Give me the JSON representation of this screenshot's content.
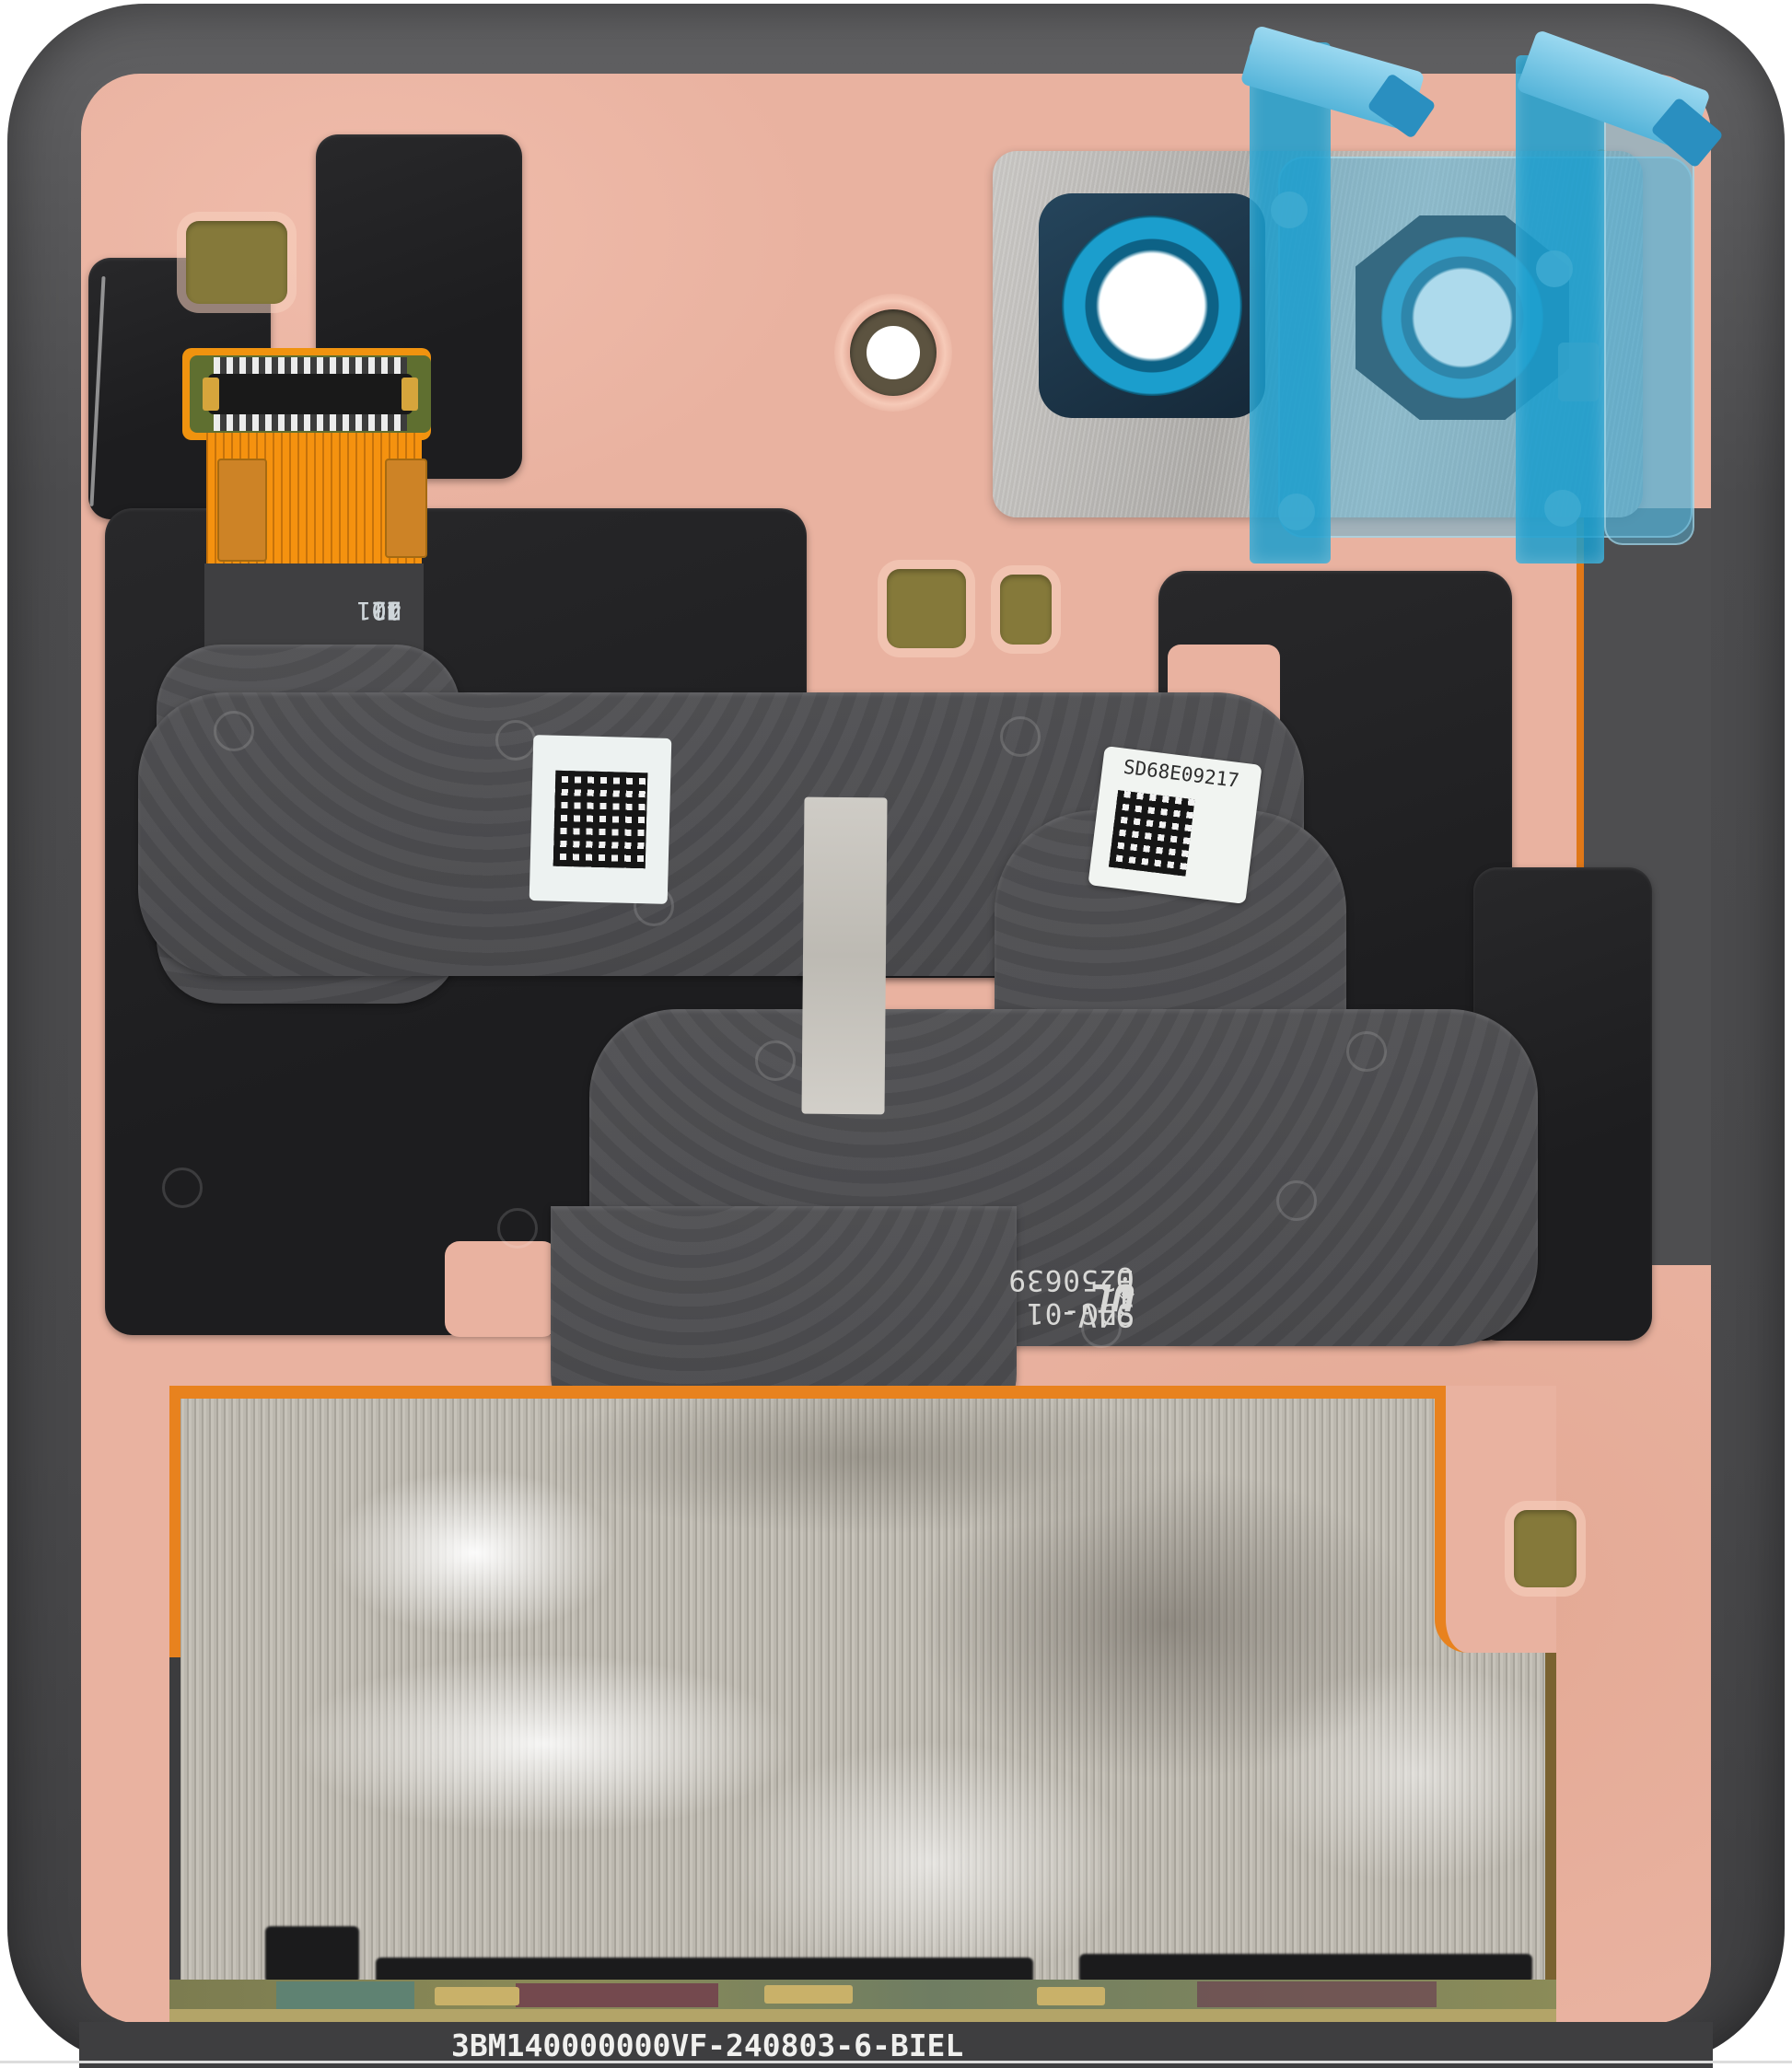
{
  "scene": {
    "title": "Smartphone rear housing internal view (service part photo)",
    "type": "product-photo"
  },
  "markings": {
    "connector_designator": "U21",
    "connector_pins": {
      "p1": "1",
      "p20": "20",
      "p21": "21",
      "p40": "40"
    },
    "serial_label": "SD68E09217",
    "flex_part_number": "SDG-01 E250639",
    "flex_cert_mark": "UL",
    "flex_cert_rating": "94V-0",
    "flex_cert_symbol": "◈",
    "flex_cert_suffix": "1",
    "bottom_batch_code": "3BM140000000VF-240803-6-BIEL"
  },
  "colors": {
    "background": "#ffffff",
    "frame_gray": "#545456",
    "backplate_salmon": "#e9b2a0",
    "graphite_black": "#212123",
    "flex_gray": "#4b4b4e",
    "flex_orange": "#f5920f",
    "tape_cyan": "#1b9fd0",
    "lens_ring_cyan": "#169bc9",
    "film_blue": "#54b2d8",
    "camera_silver": "#b3b1ae",
    "foil_silver": "#b5b1a8",
    "foil_border_orange": "#e8821e",
    "gold_pad": "#85793a",
    "label_white": "#f1f4f2",
    "bottom_bar": "#3e3e40"
  }
}
